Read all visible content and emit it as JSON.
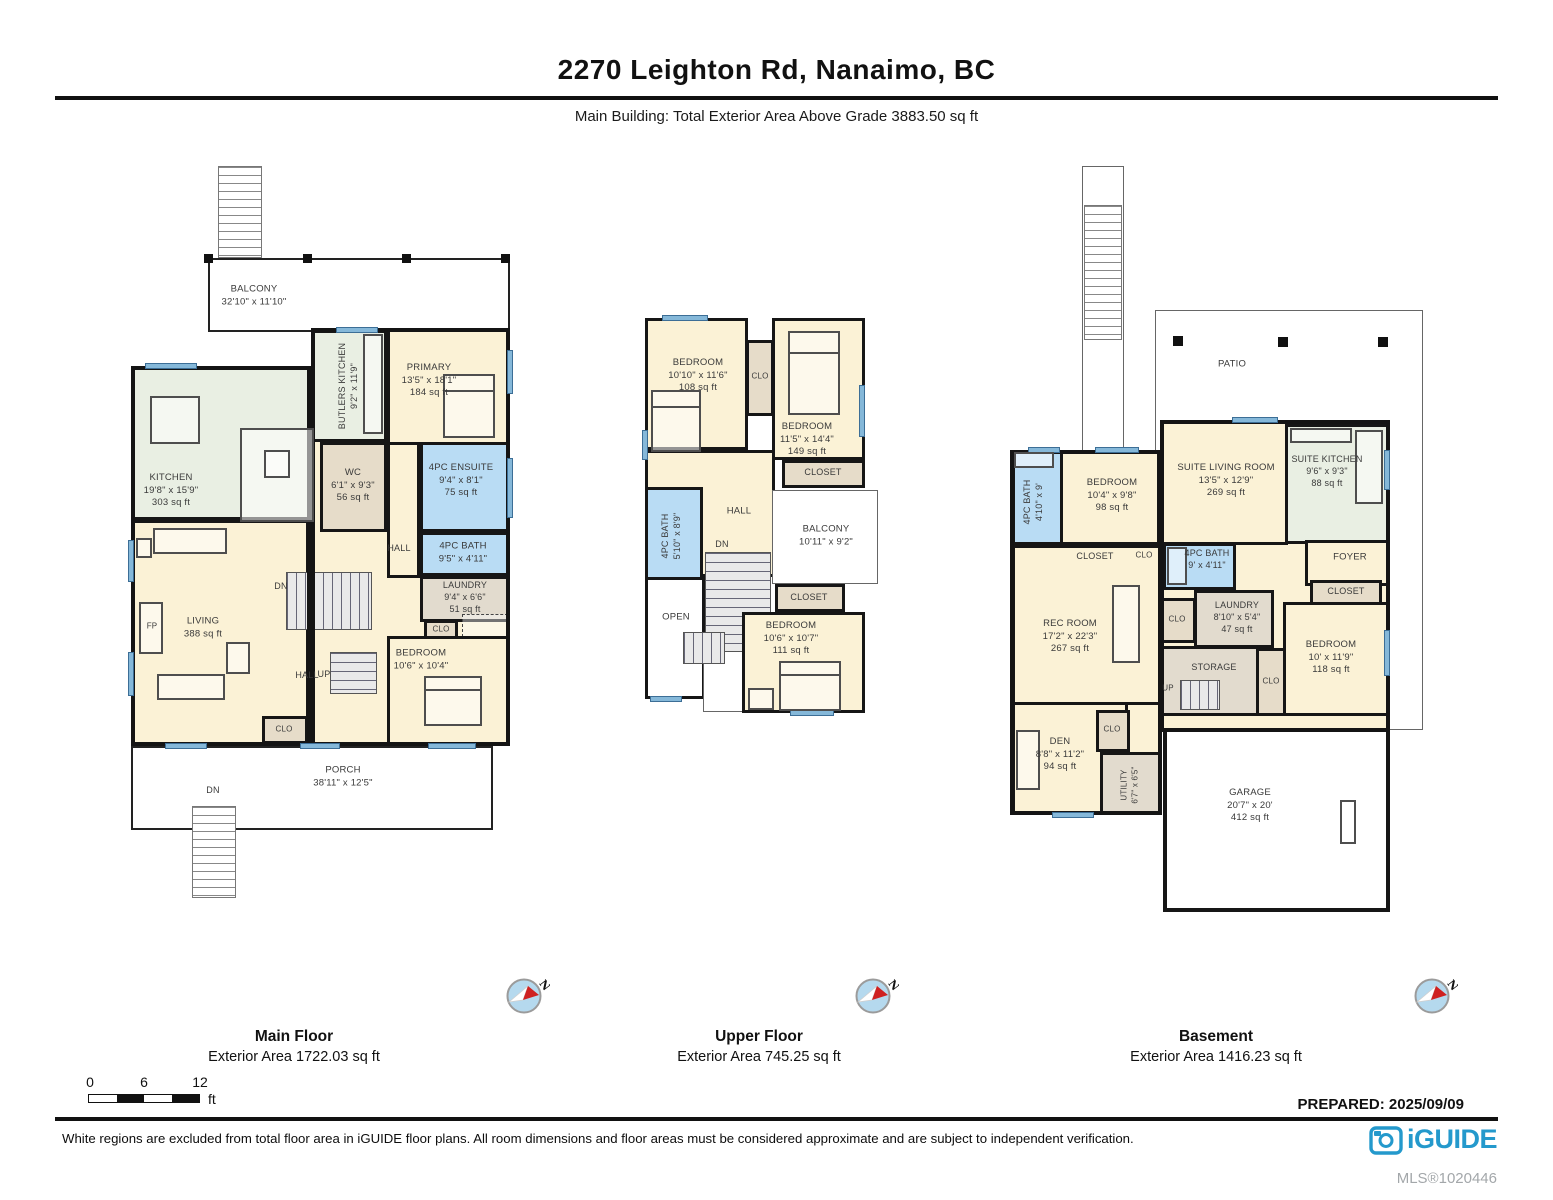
{
  "doc": {
    "title": "2270 Leighton Rd, Nanaimo, BC",
    "subtitle": "Main Building: Total Exterior Area Above Grade 3883.50 sq ft",
    "prepared": "PREPARED: 2025/09/09",
    "disclaimer": "White regions are excluded from total floor area in iGUIDE floor plans. All room dimensions and floor areas must be considered approximate and are subject to independent verification.",
    "brand": "iGUIDE",
    "mls": "MLS®1020446"
  },
  "palette": {
    "brand_blue": "#2499cc",
    "wall_black": "#161616",
    "room_cream": "#fbf2d6",
    "room_green": "#e9efe3",
    "room_blue": "#b9dcf4",
    "room_tan": "#e6dcc9",
    "window_blue": "#85b8d9",
    "compass_red": "#cf2121"
  },
  "compass": {
    "letter": "N"
  },
  "scale_bar": {
    "t0": "0",
    "t6": "6",
    "t12": "12",
    "unit": "ft"
  },
  "captions": {
    "main": {
      "name": "Main Floor",
      "area": "Exterior Area 1722.03 sq ft"
    },
    "upper": {
      "name": "Upper Floor",
      "area": "Exterior Area 745.25 sq ft"
    },
    "basement": {
      "name": "Basement",
      "area": "Exterior Area 1416.23 sq ft"
    }
  },
  "floors": {
    "main": {
      "rooms": {
        "balcony": {
          "name": "BALCONY",
          "dims": "32'10\" x 11'10\""
        },
        "kitchen": {
          "name": "KITCHEN",
          "dims": "19'8\" x 15'9\"",
          "area": "303 sq ft"
        },
        "butlers": {
          "name": "BUTLERS KITCHEN",
          "dims": "9'2\" x 11'9\""
        },
        "primary": {
          "name": "PRIMARY",
          "dims": "13'5\" x 18'1\"",
          "area": "184 sq ft"
        },
        "wc": {
          "name": "WC",
          "dims": "6'1\" x 9'3\"",
          "area": "56 sq ft"
        },
        "ensuite": {
          "name": "4PC ENSUITE",
          "dims": "9'4\" x 8'1\"",
          "area": "75 sq ft"
        },
        "bath": {
          "name": "4PC BATH",
          "dims": "9'5\" x 4'11\""
        },
        "laundry": {
          "name": "LAUNDRY",
          "dims": "9'4\" x 6'6\"",
          "area": "51 sq ft"
        },
        "living": {
          "name": "LIVING",
          "area": "388 sq ft"
        },
        "bedroom": {
          "name": "BEDROOM",
          "dims": "10'6\" x 10'4\""
        },
        "porch": {
          "name": "PORCH",
          "dims": "38'11\" x 12'5\""
        },
        "hall": "HALL",
        "hall2": "HALL",
        "clo1": "CLO",
        "clo2": "CLO",
        "fp": "FP",
        "dn": "DN",
        "dn_porch": "DN",
        "up": "UP"
      }
    },
    "upper": {
      "rooms": {
        "bedroom1": {
          "name": "BEDROOM",
          "dims": "10'10\" x 11'6\"",
          "area": "108 sq ft"
        },
        "clo": "CLO",
        "bedroom2": {
          "name": "BEDROOM",
          "dims": "11'5\" x 14'4\"",
          "area": "149 sq ft"
        },
        "closet1": "CLOSET",
        "bath": {
          "name": "4PC BATH",
          "dims": "5'10\" x 8'9\""
        },
        "hall": "HALL",
        "dn": "DN",
        "open": "OPEN",
        "balcony": {
          "name": "BALCONY",
          "dims": "10'11\" x 9'2\""
        },
        "closet2": "CLOSET",
        "bedroom3": {
          "name": "BEDROOM",
          "dims": "10'6\" x 10'7\"",
          "area": "111 sq ft"
        }
      }
    },
    "basement": {
      "rooms": {
        "patio": "PATIO",
        "bath1": {
          "name": "4PC BATH",
          "dims": "4'10\" x 9'"
        },
        "bedroom1": {
          "name": "BEDROOM",
          "dims": "10'4\" x 9'8\"",
          "area": "98 sq ft"
        },
        "suite_living": {
          "name": "SUITE LIVING ROOM",
          "dims": "13'5\" x 12'9\"",
          "area": "269 sq ft"
        },
        "suite_kitchen": {
          "name": "SUITE KITCHEN",
          "dims": "9'6\" x 9'3\"",
          "area": "88 sq ft"
        },
        "closet1": "CLOSET",
        "clo1": "CLO",
        "bath2": {
          "name": "4PC BATH",
          "dims": "9' x 4'11\""
        },
        "foyer": "FOYER",
        "closet2": "CLOSET",
        "rec": {
          "name": "REC ROOM",
          "dims": "17'2\" x 22'3\"",
          "area": "267 sq ft"
        },
        "clo2": "CLO",
        "laundry": {
          "name": "LAUNDRY",
          "dims": "8'10\" x 5'4\"",
          "area": "47 sq ft"
        },
        "storage": "STORAGE",
        "up": "UP",
        "bedroom2": {
          "name": "BEDROOM",
          "dims": "10' x 11'9\"",
          "area": "118 sq ft"
        },
        "clo3": "CLO",
        "den": {
          "name": "DEN",
          "dims": "8'8\" x 11'2\"",
          "area": "94 sq ft"
        },
        "clo4": "CLO",
        "utility": {
          "name": "UTILITY",
          "dims": "6'7\" x 6'5\""
        },
        "garage": {
          "name": "GARAGE",
          "dims": "20'7\" x 20'",
          "area": "412 sq ft"
        }
      }
    }
  }
}
